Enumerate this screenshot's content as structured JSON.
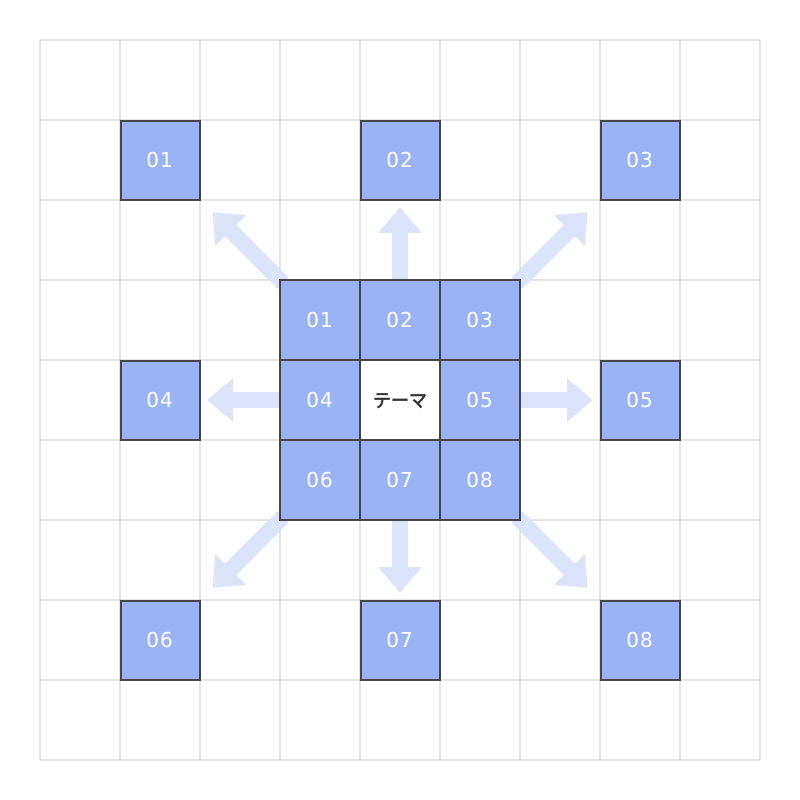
{
  "diagram": {
    "type": "mandala-chart",
    "grid": {
      "rows": 9,
      "cols": 9
    },
    "theme_label": "テーマ",
    "center_block": {
      "cells": [
        "01",
        "02",
        "03",
        "04",
        "テーマ",
        "05",
        "06",
        "07",
        "08"
      ]
    },
    "outer_cells": [
      {
        "label": "01",
        "row": 1,
        "col": 1
      },
      {
        "label": "02",
        "row": 1,
        "col": 4
      },
      {
        "label": "03",
        "row": 1,
        "col": 7
      },
      {
        "label": "04",
        "row": 4,
        "col": 1
      },
      {
        "label": "05",
        "row": 4,
        "col": 7
      },
      {
        "label": "06",
        "row": 7,
        "col": 1
      },
      {
        "label": "07",
        "row": 7,
        "col": 4
      },
      {
        "label": "08",
        "row": 7,
        "col": 7
      }
    ],
    "arrows": [
      "up-left",
      "up",
      "up-right",
      "left",
      "right",
      "down-left",
      "down",
      "down-right"
    ],
    "colors": {
      "cell_fill": "#99b3f5",
      "cell_border": "#45454b",
      "grid_line": "#c8c8c8",
      "arrow_fill": "#dbe4fb",
      "theme_text": "#333333",
      "cell_text": "#ffffff",
      "background": "#ffffff"
    }
  }
}
